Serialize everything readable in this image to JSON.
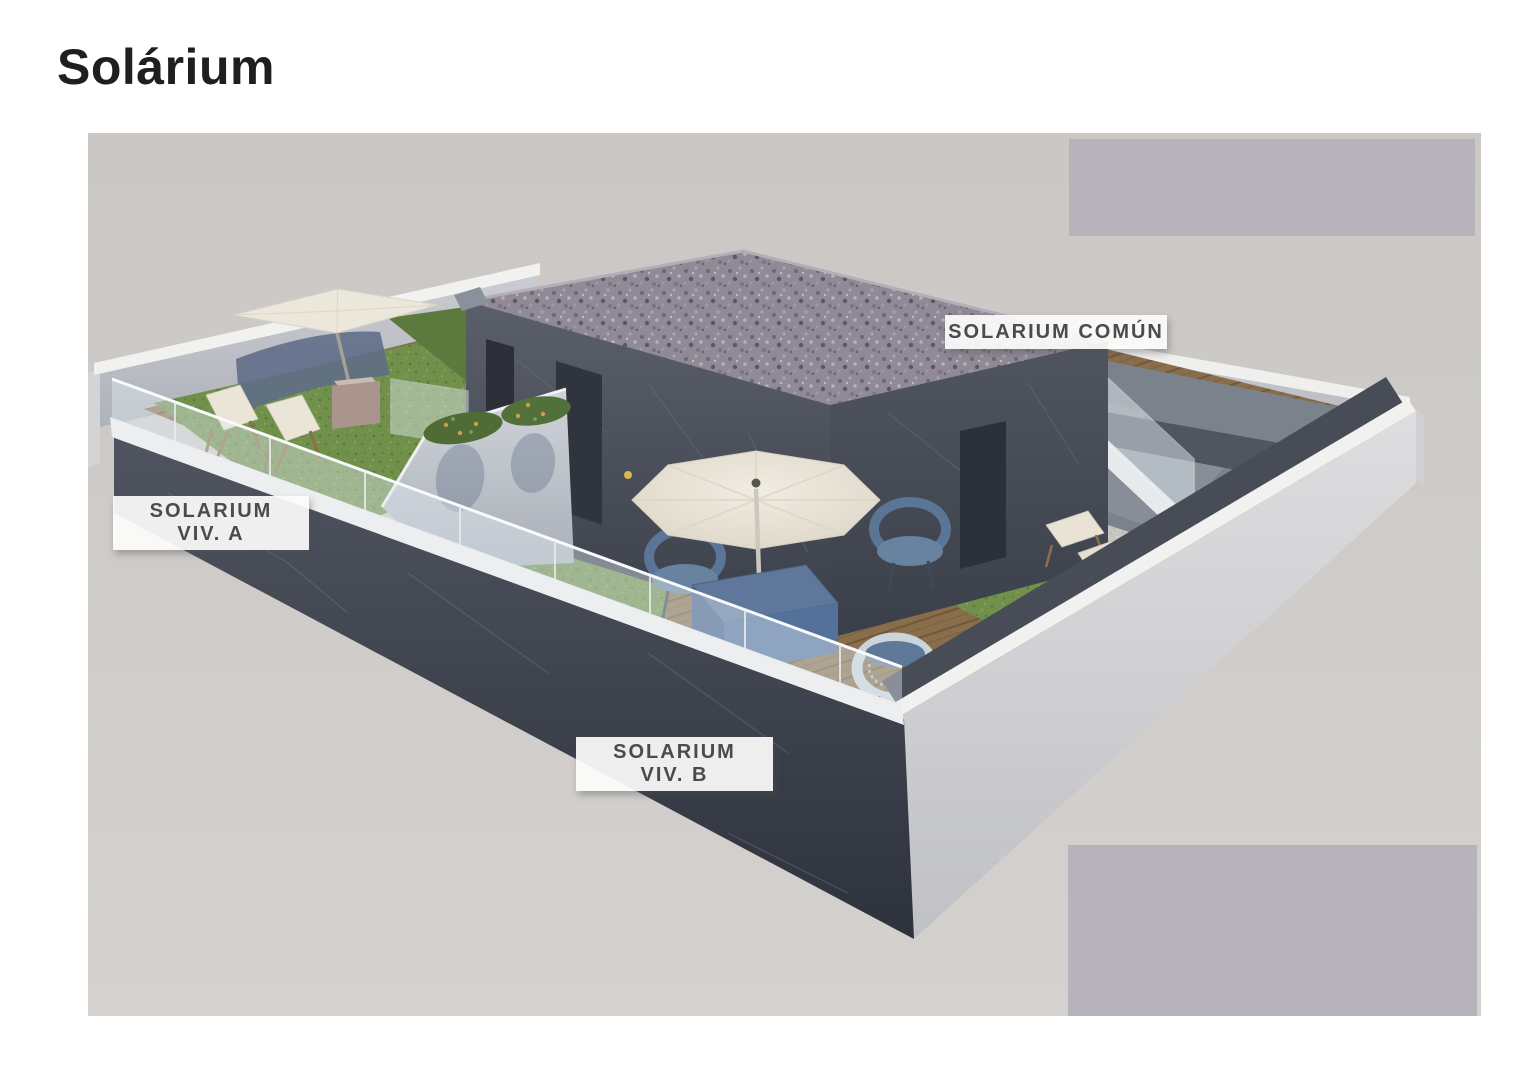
{
  "page": {
    "title": "Solárium"
  },
  "scene": {
    "labels": {
      "viv_a": {
        "line1": "SOLARIUM",
        "line2": "VIV. A"
      },
      "viv_b": {
        "line1": "SOLARIUM",
        "line2": "VIV. B"
      },
      "comun": {
        "line1": "SOLARIUM COMÚN"
      }
    },
    "colors": {
      "page_background": "#ffffff",
      "canvas_background": "#cfccc9",
      "placeholder_box": "#b7b3ba",
      "title_text": "#201e1f",
      "label_text": "#4b4b4b",
      "label_background": "#fcfcfb",
      "slate_wall": "#3f4450",
      "light_wall": "#c2c4c9",
      "wall_cap_white": "#f1f1f0",
      "wood_deck": "#8a6e4c",
      "grass": "#70904b",
      "pool_water": "#93aec6",
      "gravel_roof": "#8f8a96",
      "umbrella_canvas": "#eae4d8",
      "furniture_blue": "#5d7899",
      "deckchair_canvas": "#ebe5d7"
    }
  }
}
